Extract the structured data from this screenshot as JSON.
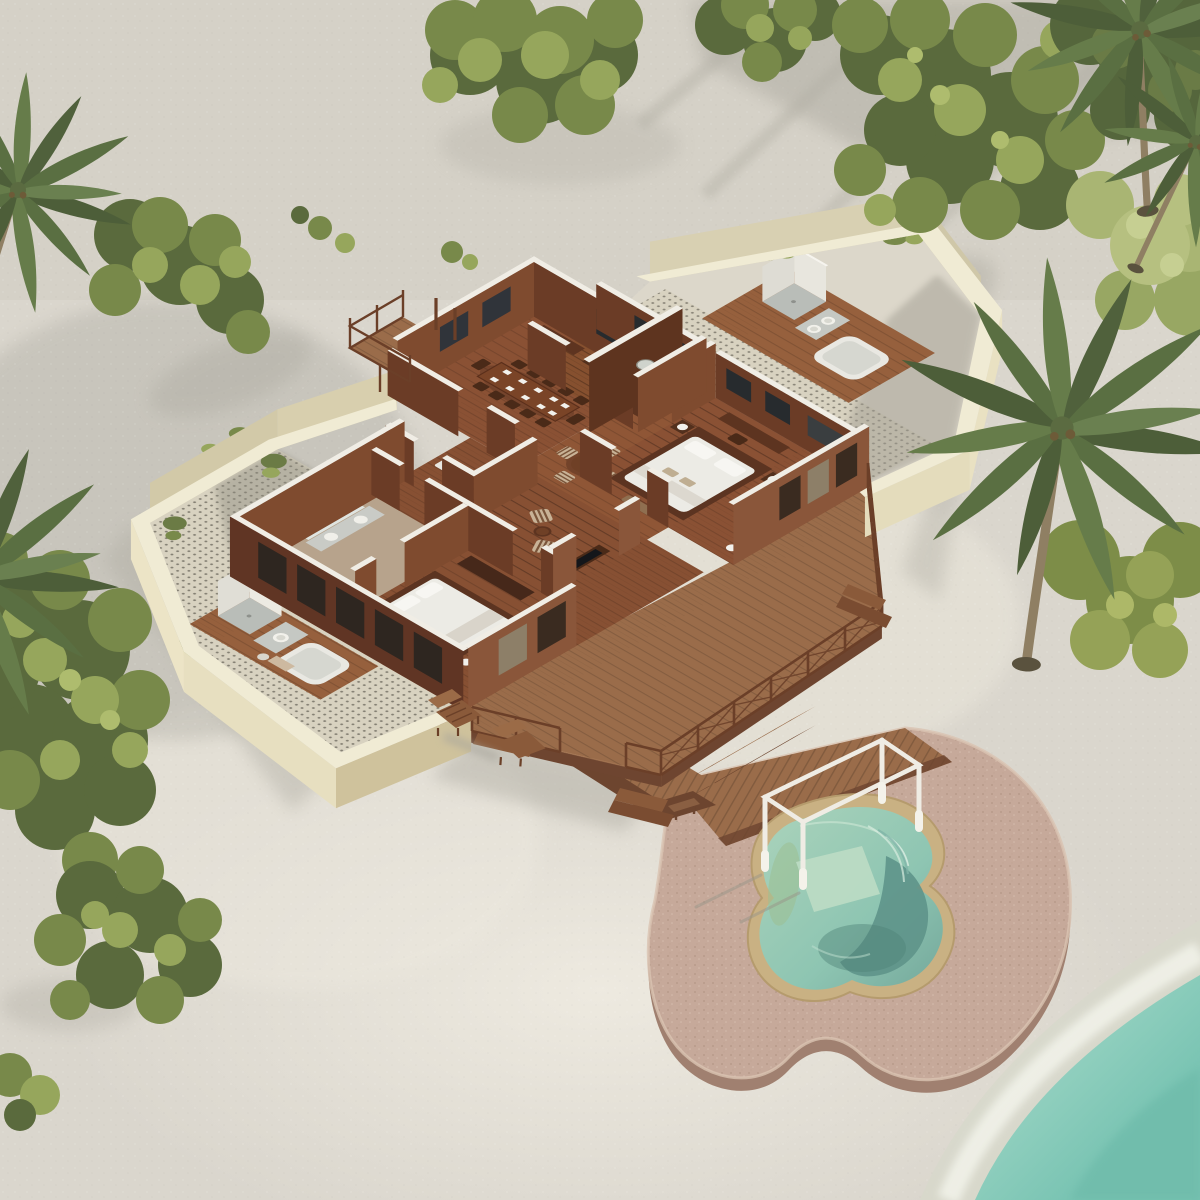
{
  "scene": {
    "type": "aerial-isometric-3d-render-of-tropical-beach-villa-floorplan",
    "environment": {
      "ground": "white-sand-beach",
      "water": "turquoise-lagoon-bottom-right-corner",
      "vegetation": [
        "tropical-tree-clusters",
        "dense-bushes",
        "coconut-palms"
      ]
    },
    "villa": {
      "style": "roofless-cutaway-floorplan, dark tropical hardwood, white cut-wall tops",
      "rooms": [
        {
          "name": "dining-room",
          "furniture": [
            "long-dining-table",
            "ten-chairs",
            "place-settings",
            "sideboard"
          ]
        },
        {
          "name": "study",
          "furniture": [
            "built-in-L-desk",
            "step-shelf",
            "stool"
          ]
        },
        {
          "name": "foyer",
          "furniture": [
            "round-table",
            "four-striped-chairs"
          ]
        },
        {
          "name": "master-bedroom",
          "furniture": [
            "double-bed-white-linen",
            "two-nightstands-with-lamps",
            "desk",
            "foot-bench",
            "standing-lamp"
          ]
        },
        {
          "name": "guest-bedroom",
          "furniture": [
            "double-bed-white-linen",
            "wardrobe",
            "side-table",
            "lamp"
          ]
        },
        {
          "name": "living-area",
          "furniture": [
            "two-striped-armchairs",
            "coffee-table",
            "media-console"
          ]
        },
        {
          "name": "dressing-room",
          "furniture": [
            "white-bench",
            "wardrobe",
            "stool"
          ]
        },
        {
          "name": "indoor-bathroom",
          "furniture": [
            "vanity-two-basins",
            "wc",
            "shower"
          ]
        }
      ],
      "courtyards": [
        {
          "name": "left-bathroom-courtyard",
          "walls": "cream-plaster",
          "floor": "pebble-mosaic-dots",
          "fixtures": [
            "outdoor-shower-enclosure",
            "vanity-basin",
            "bathtub-on-wood-platform",
            "planting"
          ]
        },
        {
          "name": "right-bathroom-courtyard",
          "walls": "cream-plaster",
          "floor": "pebble-mosaic-dots-and-concrete",
          "fixtures": [
            "outdoor-shower-enclosure",
            "vanity-basin",
            "bathtub-on-wood-platform",
            "planting"
          ],
          "lighting": "large-diagonal-cast-shadow"
        }
      ],
      "balcony": {
        "name": "dining-balcony",
        "feature": "timber-railing"
      },
      "deck": {
        "railings": "timber-posts-with-cross-lattice",
        "stairs": 3,
        "furniture": [
          "two-lounge-chairs-on-sand",
          "picnic-table"
        ]
      },
      "boardwalk": {
        "segments": 2,
        "leads-to": "pool-terrace",
        "extras": [
          "small-bench"
        ]
      }
    },
    "pool_terrace": {
      "platform": "free-form-pink-stone-slab",
      "pool": {
        "shape": "free-form-kidney",
        "rim": "sand-colored-coping",
        "zones": [
          "pale-green-shallow",
          "light-ledge",
          "deep-teal",
          "fan-entry-steps"
        ]
      },
      "pergola": "white-open-frame-four-posts",
      "deck_section": "timber-planks-top-edge"
    },
    "palette": {
      "sand": "#dad6cd",
      "sandBright": "#efece2",
      "shadow": "#a8a59b",
      "woodFloor": "#8a5134",
      "woodDeck": "#9a6c4a",
      "woodDark": "#5e3421",
      "woodMid": "#6b3c26",
      "woodLit": "#7f4b2f",
      "woodFacadeLit": "#8a563a",
      "wallTop": "#f0ede5",
      "cream": "#f0ebd4",
      "creamFace": "#ece4c6",
      "creamShade": "#cfc29c",
      "mosaic": "#d8d2c0",
      "fixtureWhite": "#e9e8e2",
      "bedWhite": "#ecebe5",
      "stone": "#c6a99a",
      "stoneSide": "#a08070",
      "poolRim": "#c9b183",
      "poolWater": "#8ec5b2",
      "poolDeep": "#5e948a",
      "poolShallow": "#a8cfb4",
      "sea": "#7fc5b5",
      "seaFoam": "#f2f3ea",
      "greenDark": "#4d5e39",
      "greenMid": "#78894a",
      "greenLight": "#96a65c",
      "greenPale": "#b6c080"
    }
  }
}
